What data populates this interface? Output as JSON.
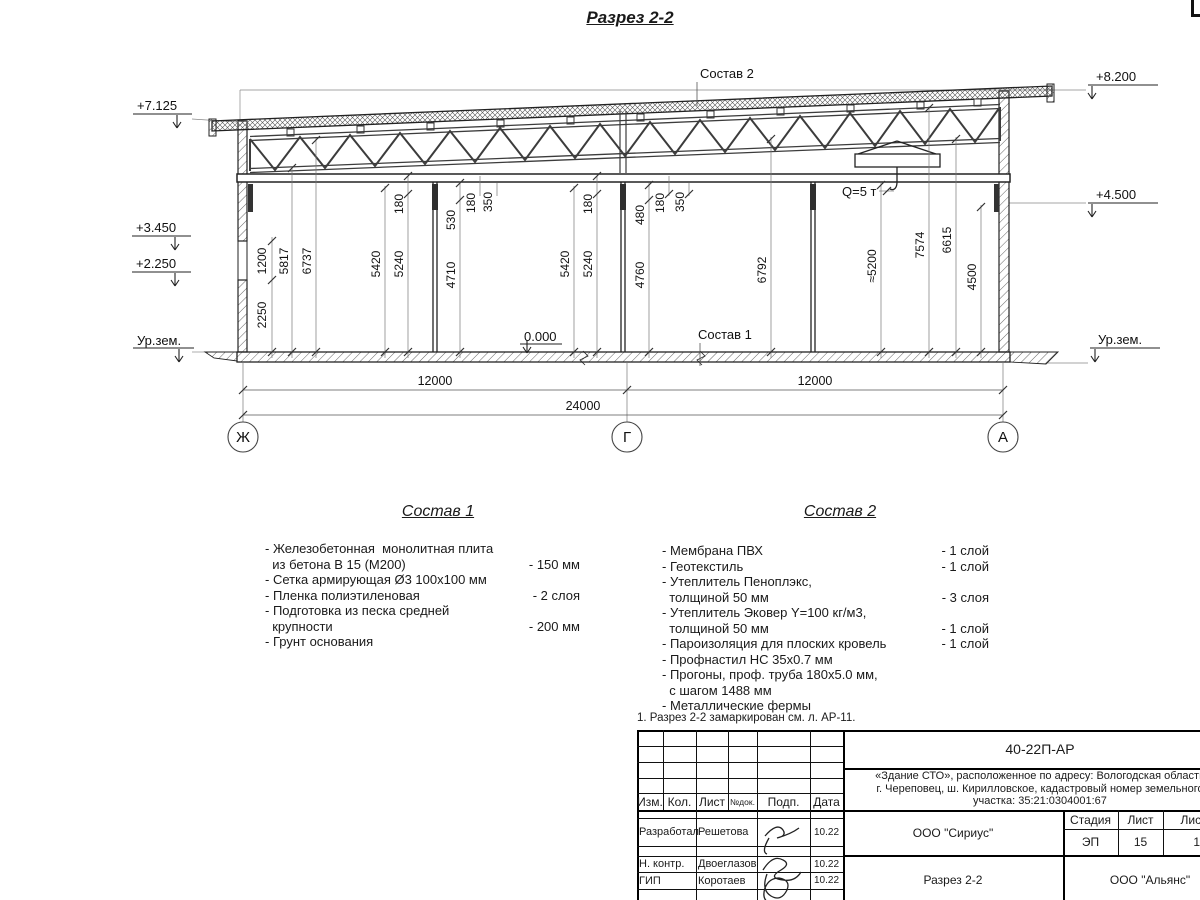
{
  "title": "Разрез 2-2",
  "drawing": {
    "callouts": {
      "sostav2": "Состав 2",
      "sostav1": "Состав 1",
      "zero": "0.000",
      "crane": "Q=5 т"
    },
    "elev_left": [
      "+7.125",
      "+3.450",
      "+2.250",
      "Ур.зем."
    ],
    "elev_right": [
      "+8.200",
      "+4.500",
      "Ур.зем."
    ],
    "vdims": [
      "2250",
      "1200",
      "5817",
      "6737",
      "5420",
      "5240",
      "180",
      "530",
      "4710",
      "180",
      "350",
      "5420",
      "5240",
      "180",
      "480",
      "4760",
      "180",
      "350",
      "6792",
      "≈5200",
      "7574",
      "6615",
      "4500"
    ],
    "hdims": [
      "12000",
      "12000",
      "24000"
    ],
    "axes": [
      "Ж",
      "Г",
      "А"
    ]
  },
  "sostav1": {
    "title": "Состав 1",
    "items": [
      {
        "text": "- Железобетонная  монолитная плита\n  из бетона В 15 (М200)",
        "value": "- 150 мм"
      },
      {
        "text": "- Сетка армирующая Ø3 100х100 мм",
        "value": ""
      },
      {
        "text": "- Пленка полиэтиленовая",
        "value": "-  2 слоя"
      },
      {
        "text": "- Подготовка из песка средней\n  крупности",
        "value": "- 200 мм"
      },
      {
        "text": "- Грунт основания",
        "value": ""
      }
    ]
  },
  "sostav2": {
    "title": "Состав 2",
    "items": [
      {
        "text": "- Мембрана ПВХ",
        "value": "- 1 слой"
      },
      {
        "text": "- Геотекстиль",
        "value": "- 1 слой"
      },
      {
        "text": "- Утеплитель Пеноплэкс,\n  толщиной 50 мм",
        "value": "- 3 слоя"
      },
      {
        "text": "- Утеплитель Эковер Y=100 кг/м3,\n  толщиной 50 мм",
        "value": "- 1 слой"
      },
      {
        "text": "- Пароизоляция для плоских кровель",
        "value": "- 1 слой"
      },
      {
        "text": "- Профнастил НС 35х0.7 мм",
        "value": ""
      },
      {
        "text": "- Прогоны, проф. труба 180х5.0 мм,\n  с шагом 1488 мм",
        "value": ""
      },
      {
        "text": "- Металлические фермы",
        "value": ""
      }
    ]
  },
  "note": "1. Разрез 2-2 замаркирован см. л. АР-11.",
  "titleblock": {
    "doc_number": "40-22П-АР",
    "project": "«Здание СТО», расположенное по адресу: Вологодская область\nг. Череповец, ш. Кирилловское, кадастровый номер земельного\nучастка: 35:21:0304001:67",
    "cols": [
      "Изм.",
      "Кол.",
      "Лист",
      "№док.",
      "Подп.",
      "Дата"
    ],
    "rows": [
      {
        "role": "Разработал",
        "name": "Решетова",
        "date": "10.22"
      },
      {
        "role": "Н. контр.",
        "name": "Двоеглазов",
        "date": "10.22"
      },
      {
        "role": "ГИП",
        "name": "Коротаев",
        "date": "10.22"
      }
    ],
    "org1": "ООО \"Сириус\"",
    "sheet_title": "Разрез 2-2",
    "org2": "ООО \"Альянс\"",
    "stage_label": "Стадия",
    "sheet_label": "Лист",
    "sheets_label": "Листов",
    "stage": "ЭП",
    "sheet": "15",
    "sheets": "16"
  }
}
